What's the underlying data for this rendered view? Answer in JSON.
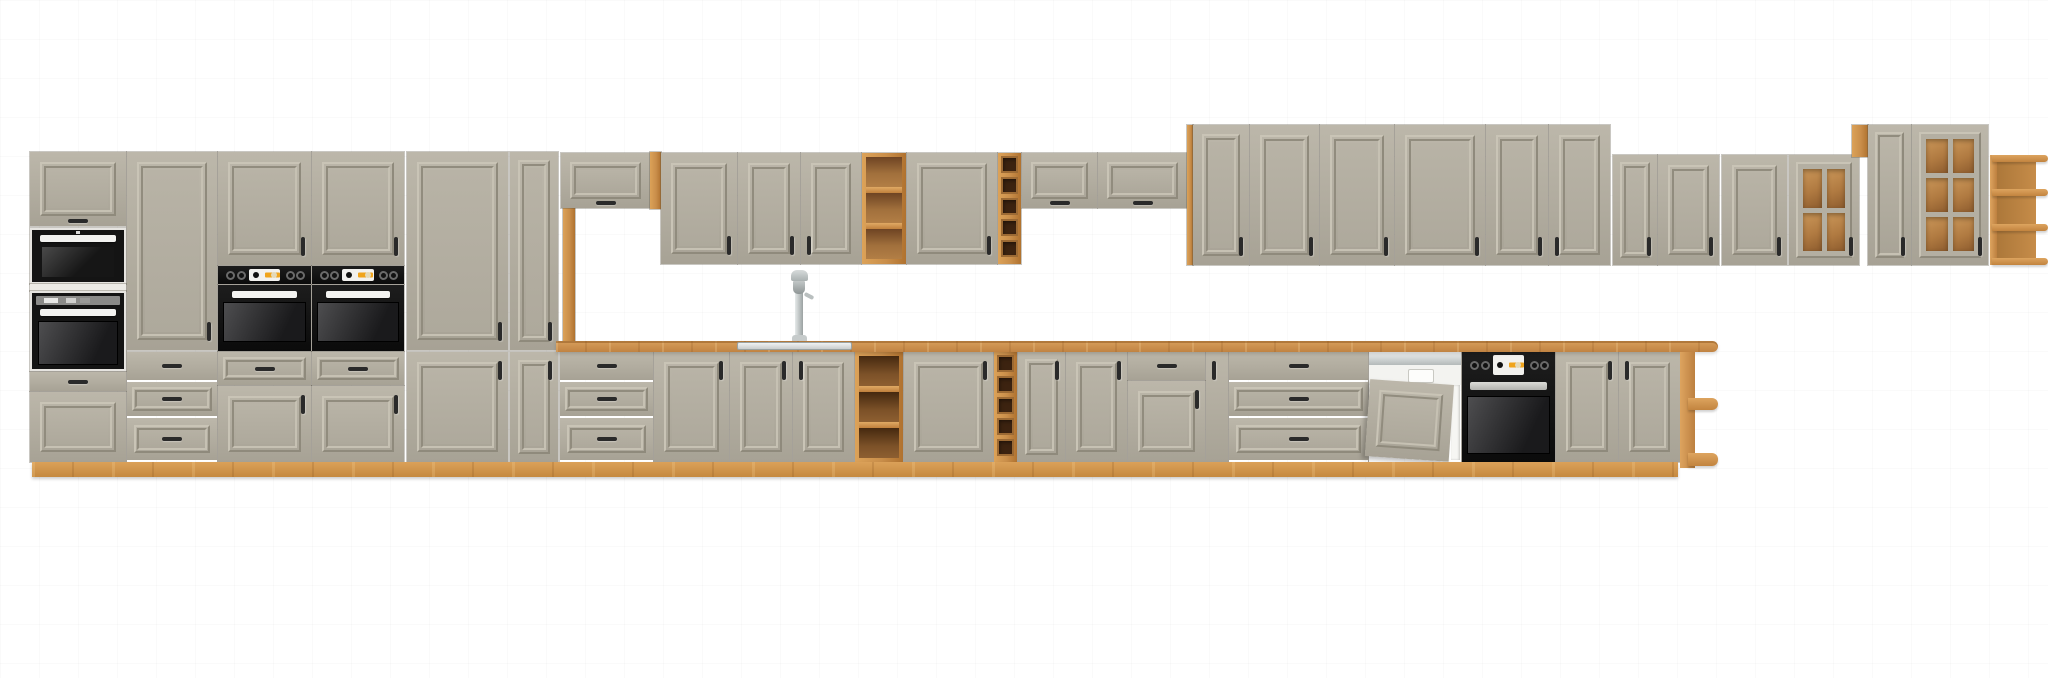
{
  "scene": {
    "width": 2048,
    "height": 678,
    "description": "Front-view 3D product render of a long modular kitchen furniture line-up: clay-grey cathedral-frame fronts, artisan oak carcass/countertop/plinth, built-in black ovens and microwave, semi-integrated dishwasher, sink with tall faucet, open oak shelves, wine racks and glass-door wall cabinets on a plain white background."
  },
  "palette": {
    "cabinet_front": "#b1ac9f",
    "cabinet_front_light": "#bcb7aa",
    "cabinet_front_dark": "#a7a295",
    "oak_wood": "#c98e4a",
    "oak_wood_light": "#dca258",
    "oak_wood_dark": "#b0722f",
    "appliance_black": "#141414",
    "display_orange": "#f0a41c",
    "steel": "#c6cbcb",
    "background": "#ffffff"
  },
  "module_names": {
    "door": "cabinet-door",
    "flap": "flap-cabinet-door",
    "drawer": "drawer-front",
    "drawers": "drawer-stack",
    "drawersW": "wide-drawer-stack",
    "microwave": "built-in-microwave",
    "ovenTall": "built-in-oven",
    "ovenPanel": "oven-control-panel",
    "oven": "built-in-oven",
    "ovenBase": "built-in-oven-with-controls",
    "dishwasher": "dishwasher-semi-integrated",
    "shelf": "open-shelf-wall-unit",
    "shelfB": "open-shelf-base-unit",
    "wine": "wine-rack",
    "glass": "glass-door-cabinet",
    "cornerShelf": "corner-open-shelf-wall",
    "cornerShelfB": "corner-open-shelf-base",
    "counter": "countertop",
    "sink": "sink-basin-inset",
    "faucet": "kitchen-faucet",
    "plinth": "plinth",
    "wood": "wood-side-panel",
    "whitesep": "appliance-divider-strip"
  },
  "modules": [
    {
      "t": "flap",
      "x": 30,
      "y": 152,
      "w": 96,
      "h": 74,
      "handle": "cb"
    },
    {
      "t": "microwave",
      "x": 30,
      "y": 228,
      "w": 96,
      "h": 56
    },
    {
      "t": "whitesep",
      "x": 30,
      "y": 284,
      "w": 96,
      "h": 7
    },
    {
      "t": "ovenTall",
      "x": 30,
      "y": 291,
      "w": 96,
      "h": 80
    },
    {
      "t": "drawer",
      "x": 30,
      "y": 372,
      "w": 96,
      "h": 19
    },
    {
      "t": "door",
      "x": 30,
      "y": 392,
      "w": 96,
      "h": 70,
      "handle": "none"
    },
    {
      "t": "door",
      "x": 127,
      "y": 152,
      "w": 90,
      "h": 198,
      "handle": "rb"
    },
    {
      "t": "drawers",
      "x": 127,
      "y": 352,
      "w": 90,
      "h": 110
    },
    {
      "t": "door",
      "x": 218,
      "y": 152,
      "w": 93,
      "h": 113,
      "handle": "rb"
    },
    {
      "t": "ovenPanel",
      "x": 218,
      "y": 266,
      "w": 93,
      "h": 18
    },
    {
      "t": "oven",
      "x": 218,
      "y": 285,
      "w": 93,
      "h": 66
    },
    {
      "t": "drawer",
      "x": 218,
      "y": 352,
      "w": 93,
      "h": 33
    },
    {
      "t": "door",
      "x": 218,
      "y": 386,
      "w": 93,
      "h": 76,
      "handle": "rt"
    },
    {
      "t": "door",
      "x": 312,
      "y": 152,
      "w": 92,
      "h": 113,
      "handle": "rb"
    },
    {
      "t": "ovenPanel",
      "x": 312,
      "y": 266,
      "w": 92,
      "h": 18
    },
    {
      "t": "oven",
      "x": 312,
      "y": 285,
      "w": 92,
      "h": 66
    },
    {
      "t": "drawer",
      "x": 312,
      "y": 352,
      "w": 92,
      "h": 33
    },
    {
      "t": "door",
      "x": 312,
      "y": 386,
      "w": 92,
      "h": 76,
      "handle": "rt"
    },
    {
      "t": "door",
      "x": 407,
      "y": 152,
      "w": 101,
      "h": 198,
      "handle": "rb"
    },
    {
      "t": "door",
      "x": 407,
      "y": 352,
      "w": 101,
      "h": 110,
      "handle": "rt"
    },
    {
      "t": "door",
      "x": 510,
      "y": 152,
      "w": 48,
      "h": 198,
      "handle": "rb"
    },
    {
      "t": "door",
      "x": 510,
      "y": 352,
      "w": 48,
      "h": 110,
      "handle": "rt"
    },
    {
      "t": "wood",
      "x": 563,
      "y": 208,
      "w": 12,
      "h": 134
    },
    {
      "t": "flap",
      "x": 561,
      "y": 153,
      "w": 89,
      "h": 55,
      "handle": "cb"
    },
    {
      "t": "wood",
      "x": 650,
      "y": 152,
      "w": 11,
      "h": 57
    },
    {
      "t": "door",
      "x": 661,
      "y": 153,
      "w": 76,
      "h": 111,
      "handle": "rb"
    },
    {
      "t": "door",
      "x": 738,
      "y": 153,
      "w": 62,
      "h": 111,
      "handle": "rb"
    },
    {
      "t": "door",
      "x": 801,
      "y": 153,
      "w": 60,
      "h": 111,
      "handle": "lb"
    },
    {
      "t": "shelf",
      "x": 862,
      "y": 153,
      "w": 44,
      "h": 111,
      "comp": 3
    },
    {
      "t": "door",
      "x": 907,
      "y": 153,
      "w": 90,
      "h": 111,
      "handle": "rb"
    },
    {
      "t": "wine",
      "x": 998,
      "y": 153,
      "w": 23,
      "h": 111,
      "comp": 5
    },
    {
      "t": "flap",
      "x": 1022,
      "y": 153,
      "w": 75,
      "h": 55,
      "handle": "cb"
    },
    {
      "t": "flap",
      "x": 1098,
      "y": 153,
      "w": 89,
      "h": 55,
      "handle": "cb"
    },
    {
      "t": "wood",
      "x": 1187,
      "y": 125,
      "w": 6,
      "h": 140
    },
    {
      "t": "door",
      "x": 1193,
      "y": 125,
      "w": 56,
      "h": 140,
      "handle": "rb"
    },
    {
      "t": "door",
      "x": 1250,
      "y": 125,
      "w": 69,
      "h": 140,
      "handle": "rb"
    },
    {
      "t": "door",
      "x": 1320,
      "y": 125,
      "w": 74,
      "h": 140,
      "handle": "rb"
    },
    {
      "t": "door",
      "x": 1395,
      "y": 125,
      "w": 90,
      "h": 140,
      "handle": "rb"
    },
    {
      "t": "door",
      "x": 1486,
      "y": 125,
      "w": 62,
      "h": 140,
      "handle": "rb"
    },
    {
      "t": "door",
      "x": 1549,
      "y": 125,
      "w": 61,
      "h": 140,
      "handle": "lb"
    },
    {
      "t": "door",
      "x": 1613,
      "y": 155,
      "w": 44,
      "h": 110,
      "handle": "rb"
    },
    {
      "t": "door",
      "x": 1658,
      "y": 155,
      "w": 61,
      "h": 110,
      "handle": "rb"
    },
    {
      "t": "door",
      "x": 1722,
      "y": 155,
      "w": 65,
      "h": 110,
      "handle": "rb"
    },
    {
      "t": "glass",
      "x": 1789,
      "y": 155,
      "w": 70,
      "h": 110,
      "cols": 2,
      "rows": 2,
      "handle": "rb"
    },
    {
      "t": "wood",
      "x": 1852,
      "y": 125,
      "w": 16,
      "h": 32
    },
    {
      "t": "door",
      "x": 1868,
      "y": 125,
      "w": 43,
      "h": 140,
      "handle": "rb"
    },
    {
      "t": "glass",
      "x": 1912,
      "y": 125,
      "w": 76,
      "h": 140,
      "cols": 2,
      "rows": 3,
      "handle": "rb"
    },
    {
      "t": "cornerShelf",
      "x": 1990,
      "y": 155,
      "w": 58,
      "h": 110
    },
    {
      "t": "drawers",
      "x": 560,
      "y": 352,
      "w": 93,
      "h": 110
    },
    {
      "t": "door",
      "x": 654,
      "y": 352,
      "w": 75,
      "h": 110,
      "handle": "rt"
    },
    {
      "t": "door",
      "x": 730,
      "y": 352,
      "w": 62,
      "h": 110,
      "handle": "rt"
    },
    {
      "t": "door",
      "x": 793,
      "y": 352,
      "w": 61,
      "h": 110,
      "handle": "lt"
    },
    {
      "t": "shelfB",
      "x": 855,
      "y": 352,
      "w": 48,
      "h": 110,
      "comp": 3
    },
    {
      "t": "door",
      "x": 904,
      "y": 352,
      "w": 89,
      "h": 110,
      "handle": "rt"
    },
    {
      "t": "wine",
      "x": 994,
      "y": 352,
      "w": 23,
      "h": 110,
      "comp": 5
    },
    {
      "t": "door",
      "x": 1018,
      "y": 352,
      "w": 47,
      "h": 110,
      "handle": "rt"
    },
    {
      "t": "door",
      "x": 1066,
      "y": 352,
      "w": 61,
      "h": 110,
      "handle": "rt"
    },
    {
      "t": "drawer",
      "x": 1128,
      "y": 352,
      "w": 77,
      "h": 28
    },
    {
      "t": "door",
      "x": 1128,
      "y": 381,
      "w": 77,
      "h": 81,
      "handle": "rt"
    },
    {
      "t": "door",
      "x": 1206,
      "y": 352,
      "w": 22,
      "h": 110,
      "handle": "lt"
    },
    {
      "t": "drawersW",
      "x": 1229,
      "y": 352,
      "w": 139,
      "h": 110
    },
    {
      "t": "dishwasher",
      "x": 1369,
      "y": 352,
      "w": 92,
      "h": 110
    },
    {
      "t": "ovenBase",
      "x": 1462,
      "y": 352,
      "w": 93,
      "h": 110
    },
    {
      "t": "door",
      "x": 1556,
      "y": 352,
      "w": 62,
      "h": 110,
      "handle": "rt"
    },
    {
      "t": "door",
      "x": 1619,
      "y": 352,
      "w": 61,
      "h": 110,
      "handle": "lt"
    },
    {
      "t": "counter",
      "x": 556,
      "y": 341,
      "w": 1162,
      "h": 11
    },
    {
      "t": "sink",
      "x": 737,
      "y": 342,
      "w": 115,
      "h": 8
    },
    {
      "t": "faucet",
      "x": 784,
      "y": 270,
      "w": 32,
      "h": 71
    },
    {
      "t": "cornerShelfB",
      "x": 1680,
      "y": 352,
      "w": 38,
      "h": 116
    },
    {
      "t": "plinth",
      "x": 32,
      "y": 462,
      "w": 1646,
      "h": 15
    }
  ]
}
